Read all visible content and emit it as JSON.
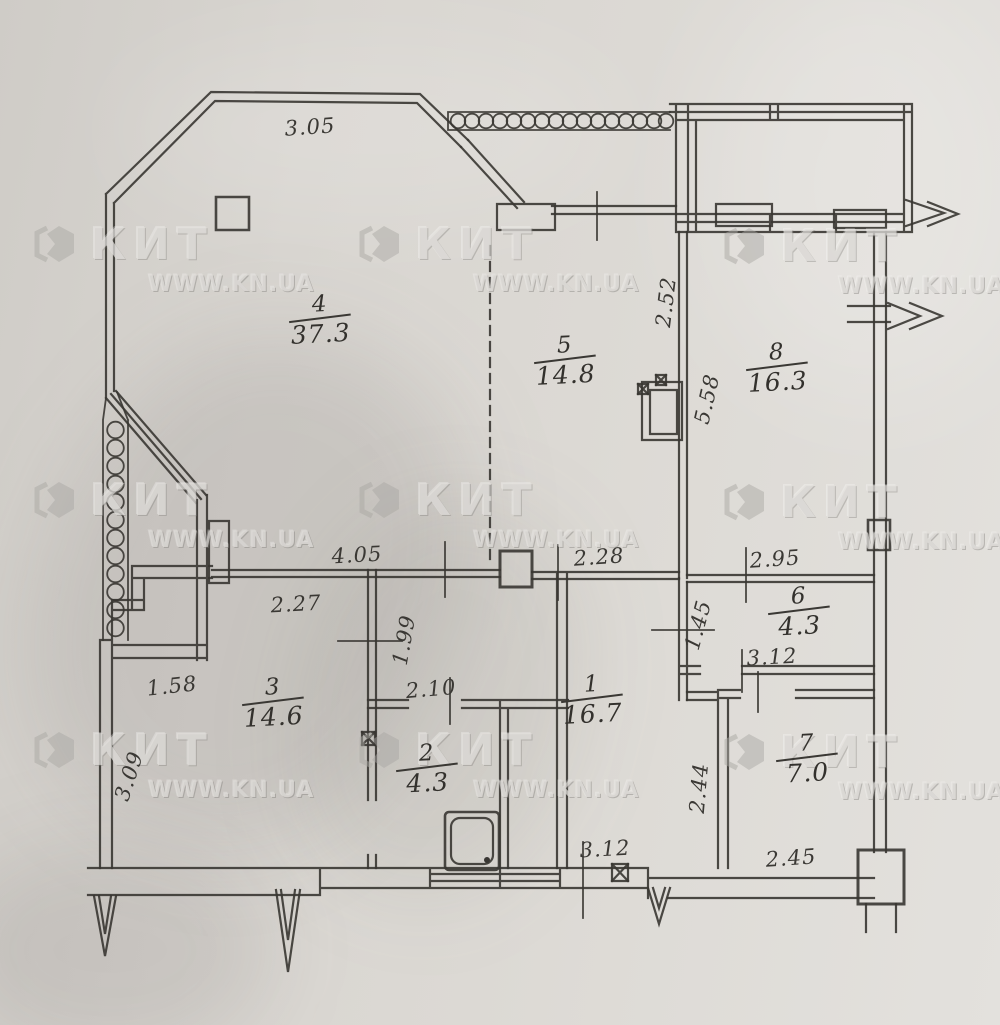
{
  "colors": {
    "ink": "#383632",
    "paper": "#d8d5d0",
    "watermark_gray": "#b9b6b1"
  },
  "floor_plan": {
    "watermark": {
      "brand": "КИТ",
      "site": "WWW.KN.UA",
      "logo_icon": "kit-hexagon-logo",
      "positions": [
        {
          "x": 30,
          "y": 220
        },
        {
          "x": 355,
          "y": 220
        },
        {
          "x": 720,
          "y": 222
        },
        {
          "x": 30,
          "y": 476
        },
        {
          "x": 355,
          "y": 476
        },
        {
          "x": 720,
          "y": 478
        },
        {
          "x": 30,
          "y": 726
        },
        {
          "x": 355,
          "y": 726
        },
        {
          "x": 720,
          "y": 728
        }
      ]
    },
    "rooms": [
      {
        "number": "4",
        "area": "37.3",
        "x": 320,
        "y": 320,
        "rot": -3
      },
      {
        "number": "5",
        "area": "14.8",
        "x": 565,
        "y": 361,
        "rot": -3
      },
      {
        "number": "8",
        "area": "16.3",
        "x": 777,
        "y": 368,
        "rot": -3
      },
      {
        "number": "6",
        "area": "4.3",
        "x": 799,
        "y": 612,
        "rot": -3
      },
      {
        "number": "3",
        "area": "14.6",
        "x": 273,
        "y": 703,
        "rot": -3
      },
      {
        "number": "1",
        "area": "16.7",
        "x": 592,
        "y": 700,
        "rot": -3
      },
      {
        "number": "2",
        "area": "4.3",
        "x": 427,
        "y": 769,
        "rot": -3
      },
      {
        "number": "7",
        "area": "7.0",
        "x": 807,
        "y": 759,
        "rot": -3
      }
    ],
    "dimensions": [
      {
        "value": "3.05",
        "x": 310,
        "y": 127,
        "rot": -4
      },
      {
        "value": "2.52",
        "x": 666,
        "y": 302,
        "rot": -83
      },
      {
        "value": "5.58",
        "x": 707,
        "y": 399,
        "rot": -77
      },
      {
        "value": "4.05",
        "x": 357,
        "y": 555,
        "rot": -3
      },
      {
        "value": "2.28",
        "x": 599,
        "y": 557,
        "rot": -4
      },
      {
        "value": "2.95",
        "x": 775,
        "y": 559,
        "rot": -4
      },
      {
        "value": "2.27",
        "x": 296,
        "y": 604,
        "rot": -3
      },
      {
        "value": "1.99",
        "x": 404,
        "y": 640,
        "rot": -80
      },
      {
        "value": "1.45",
        "x": 698,
        "y": 625,
        "rot": -75
      },
      {
        "value": "3.12",
        "x": 772,
        "y": 657,
        "rot": -3
      },
      {
        "value": "1.58",
        "x": 172,
        "y": 686,
        "rot": -6
      },
      {
        "value": "2.10",
        "x": 431,
        "y": 689,
        "rot": -5
      },
      {
        "value": "3.09",
        "x": 129,
        "y": 776,
        "rot": -72
      },
      {
        "value": "2.44",
        "x": 699,
        "y": 788,
        "rot": -85
      },
      {
        "value": "3.12",
        "x": 605,
        "y": 849,
        "rot": -3
      },
      {
        "value": "2.45",
        "x": 791,
        "y": 858,
        "rot": -4
      }
    ]
  }
}
